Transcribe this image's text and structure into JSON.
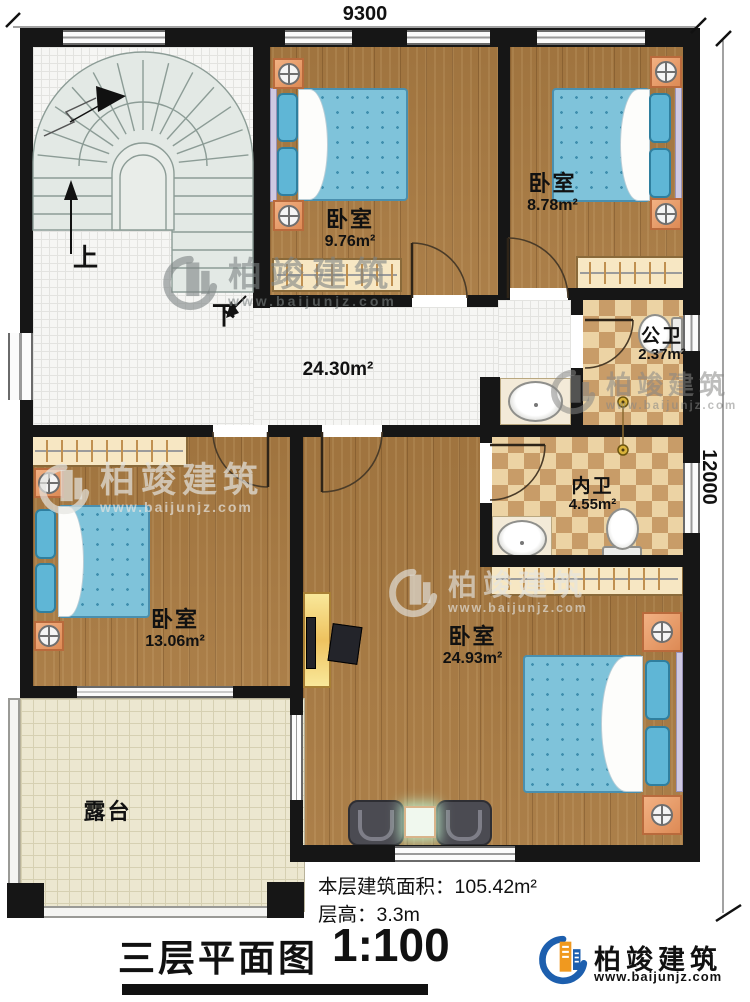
{
  "plan": {
    "dimensions": {
      "top": "9300",
      "right": "12000"
    },
    "stairs": {
      "up_label": "上",
      "down_label": "下"
    },
    "rooms": [
      {
        "key": "bedroom-top-middle",
        "name": "卧室",
        "area": "9.76m²"
      },
      {
        "key": "bedroom-top-right",
        "name": "卧室",
        "area": "8.78m²"
      },
      {
        "key": "hallway",
        "name": "",
        "area": "24.30m²"
      },
      {
        "key": "public-bathroom",
        "name": "公卫",
        "area": "2.37m²"
      },
      {
        "key": "private-bathroom",
        "name": "内卫",
        "area": "4.55m²"
      },
      {
        "key": "bedroom-middle-left",
        "name": "卧室",
        "area": "13.06m²"
      },
      {
        "key": "master-bedroom",
        "name": "卧室",
        "area": "24.93m²"
      },
      {
        "key": "terrace",
        "name": "露台",
        "area": ""
      }
    ]
  },
  "footer": {
    "floor_area_label": "本层建筑面积：",
    "floor_area_value": "105.42m²",
    "floor_height_label": "层高：",
    "floor_height_value": "3.3m",
    "title": "三层平面图",
    "scale": "1:100"
  },
  "brand": {
    "name": "柏竣建筑",
    "website": "www.baijunjz.com"
  },
  "watermark": {
    "name": "柏竣建筑",
    "website": "www.baijunjz.com"
  },
  "colors": {
    "wall": "#161616",
    "wood_floor": "#a87a42",
    "tile_floor": "#f6f6f4",
    "bath_tile_light": "#ecd3a4",
    "bath_tile_dark": "#c89c68",
    "terrace_floor": "#ece7d0",
    "bed_blue": "#7fc3da",
    "nightstand_orange": "#dd8a55",
    "logo_blue": "#1d5fae",
    "logo_orange": "#f0991f"
  }
}
